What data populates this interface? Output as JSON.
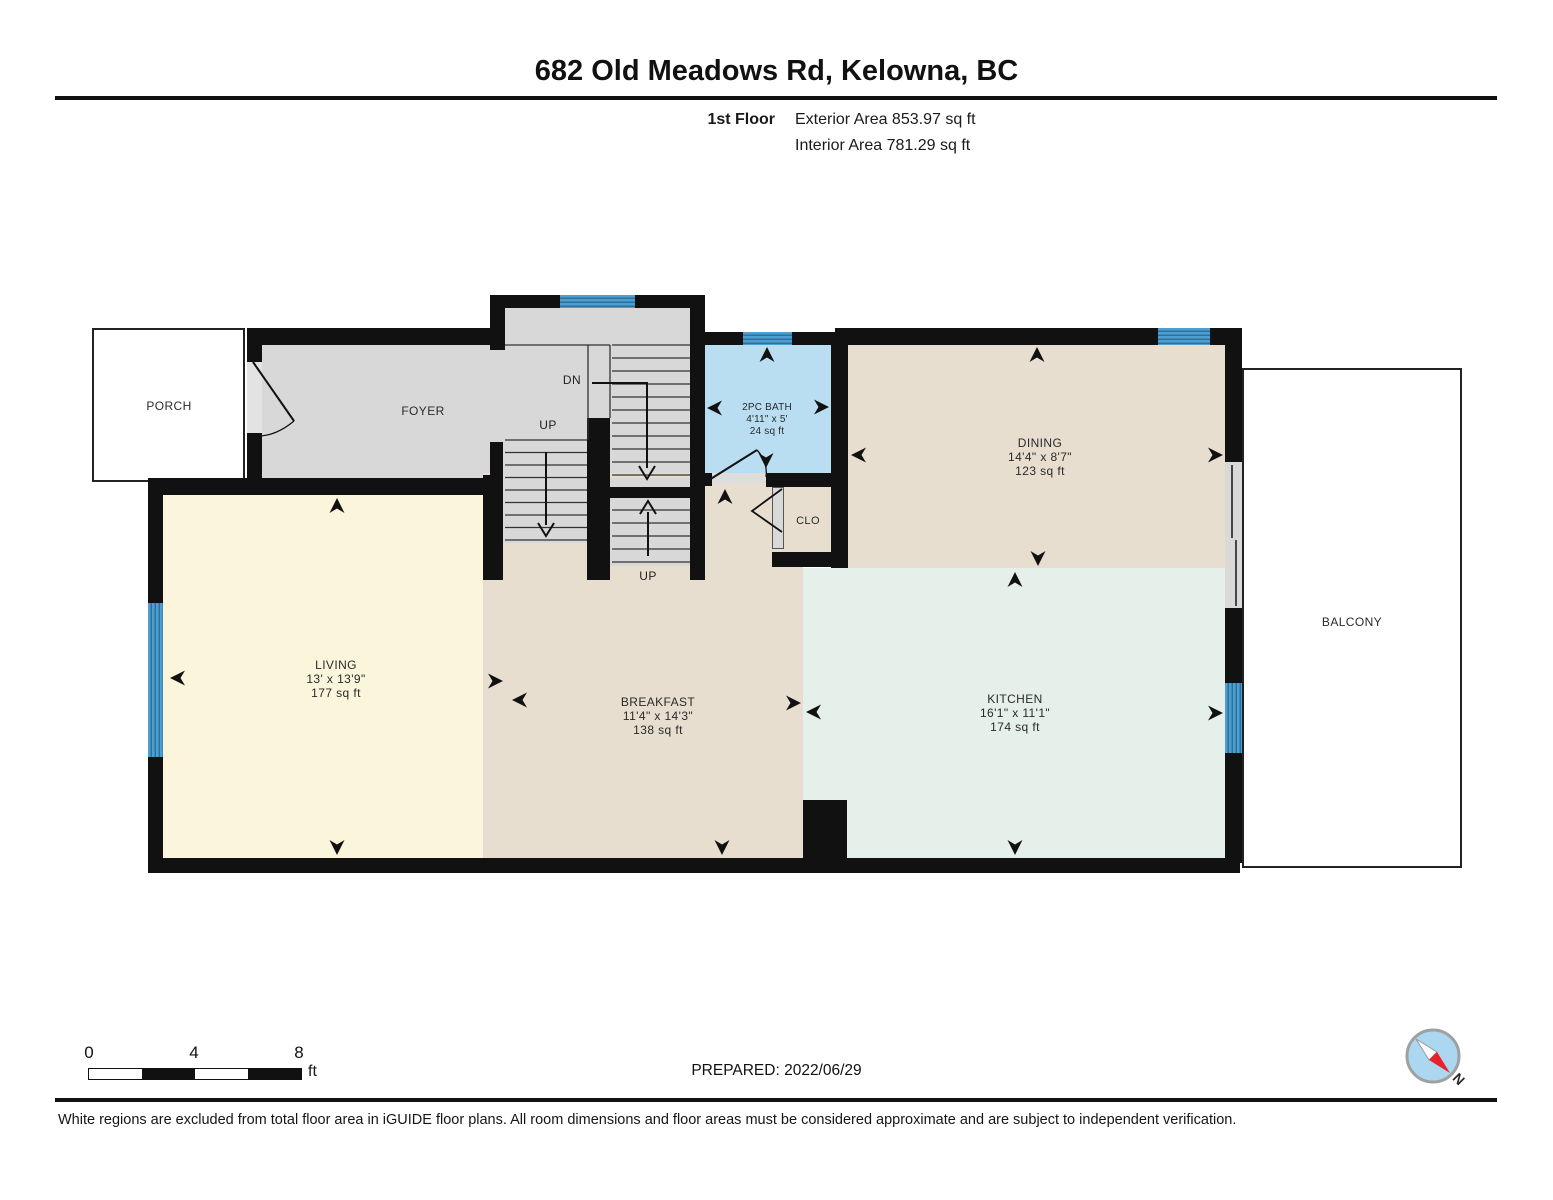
{
  "header": {
    "title": "682 Old Meadows Rd, Kelowna, BC",
    "floor_label": "1st Floor",
    "exterior_area": "Exterior Area 853.97 sq ft",
    "interior_area": "Interior Area 781.29 sq ft"
  },
  "rooms": {
    "porch": {
      "name": "PORCH"
    },
    "foyer": {
      "name": "FOYER"
    },
    "bath": {
      "name": "2PC BATH",
      "dimensions": "4'11\" x 5'",
      "area": "24 sq ft"
    },
    "dining": {
      "name": "DINING",
      "dimensions": "14'4\" x 8'7\"",
      "area": "123 sq ft"
    },
    "closet": {
      "name": "CLO"
    },
    "living": {
      "name": "LIVING",
      "dimensions": "13' x 13'9\"",
      "area": "177 sq ft"
    },
    "breakfast": {
      "name": "BREAKFAST",
      "dimensions": "11'4\" x 14'3\"",
      "area": "138 sq ft"
    },
    "kitchen": {
      "name": "KITCHEN",
      "dimensions": "16'1\" x 11'1\"",
      "area": "174 sq ft"
    },
    "balcony": {
      "name": "BALCONY"
    }
  },
  "stairs": {
    "up_upper": "UP",
    "down": "DN",
    "up_lower": "UP"
  },
  "scale_bar": {
    "tick_0": "0",
    "tick_4": "4",
    "tick_8": "8",
    "unit": "ft"
  },
  "compass": {
    "north_label": "N"
  },
  "footer": {
    "prepared": "PREPARED: 2022/06/29",
    "disclaimer": "White regions are excluded from total floor area in iGUIDE floor plans. All room dimensions and floor areas must be considered approximate and are subject to independent verification."
  },
  "colors": {
    "wall": "#111111",
    "foyer_gray": "#d8d8d8",
    "living_cream": "#fbf5dc",
    "tan": "#e7decf",
    "kitchen_mint": "#e4f0e9",
    "bath_blue": "#b9ddf1",
    "window_blue": "#4e9fd1",
    "window_stripe": "#2f709a",
    "compass_fill": "#abd7f1",
    "compass_red": "#e8212a"
  }
}
